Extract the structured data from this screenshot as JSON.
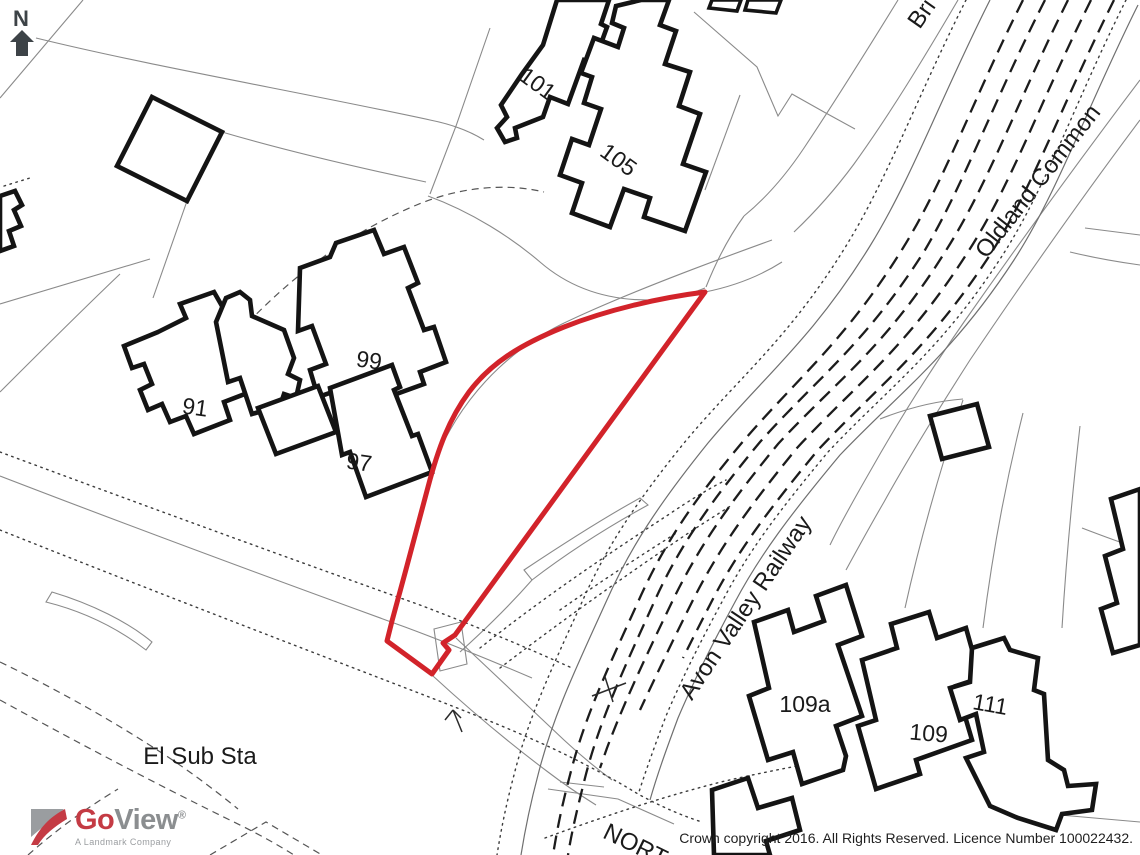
{
  "map": {
    "compass": {
      "label": "N"
    },
    "site_outline_color": "#d2232a",
    "building_labels": {
      "b101": "101",
      "b105": "105",
      "b99": "99",
      "b91": "91",
      "b97": "97",
      "b109a": "109a",
      "b109": "109",
      "b111": "111"
    },
    "feature_labels": {
      "railway": "Avon Valley Railway",
      "road_oldland": "Oldland Common",
      "road_bri_partial": "Bri",
      "substation": "El Sub Sta",
      "road_north_partial": "NORT"
    }
  },
  "branding": {
    "logo_go": "Go",
    "logo_view": "View",
    "registered_mark": "®",
    "tagline": "A Landmark Company",
    "color_red": "#c43b44",
    "color_gray": "#8b8e90"
  },
  "attribution": {
    "copyright": "Crown copyright 2016. All Rights Reserved. Licence Number 100022432."
  }
}
